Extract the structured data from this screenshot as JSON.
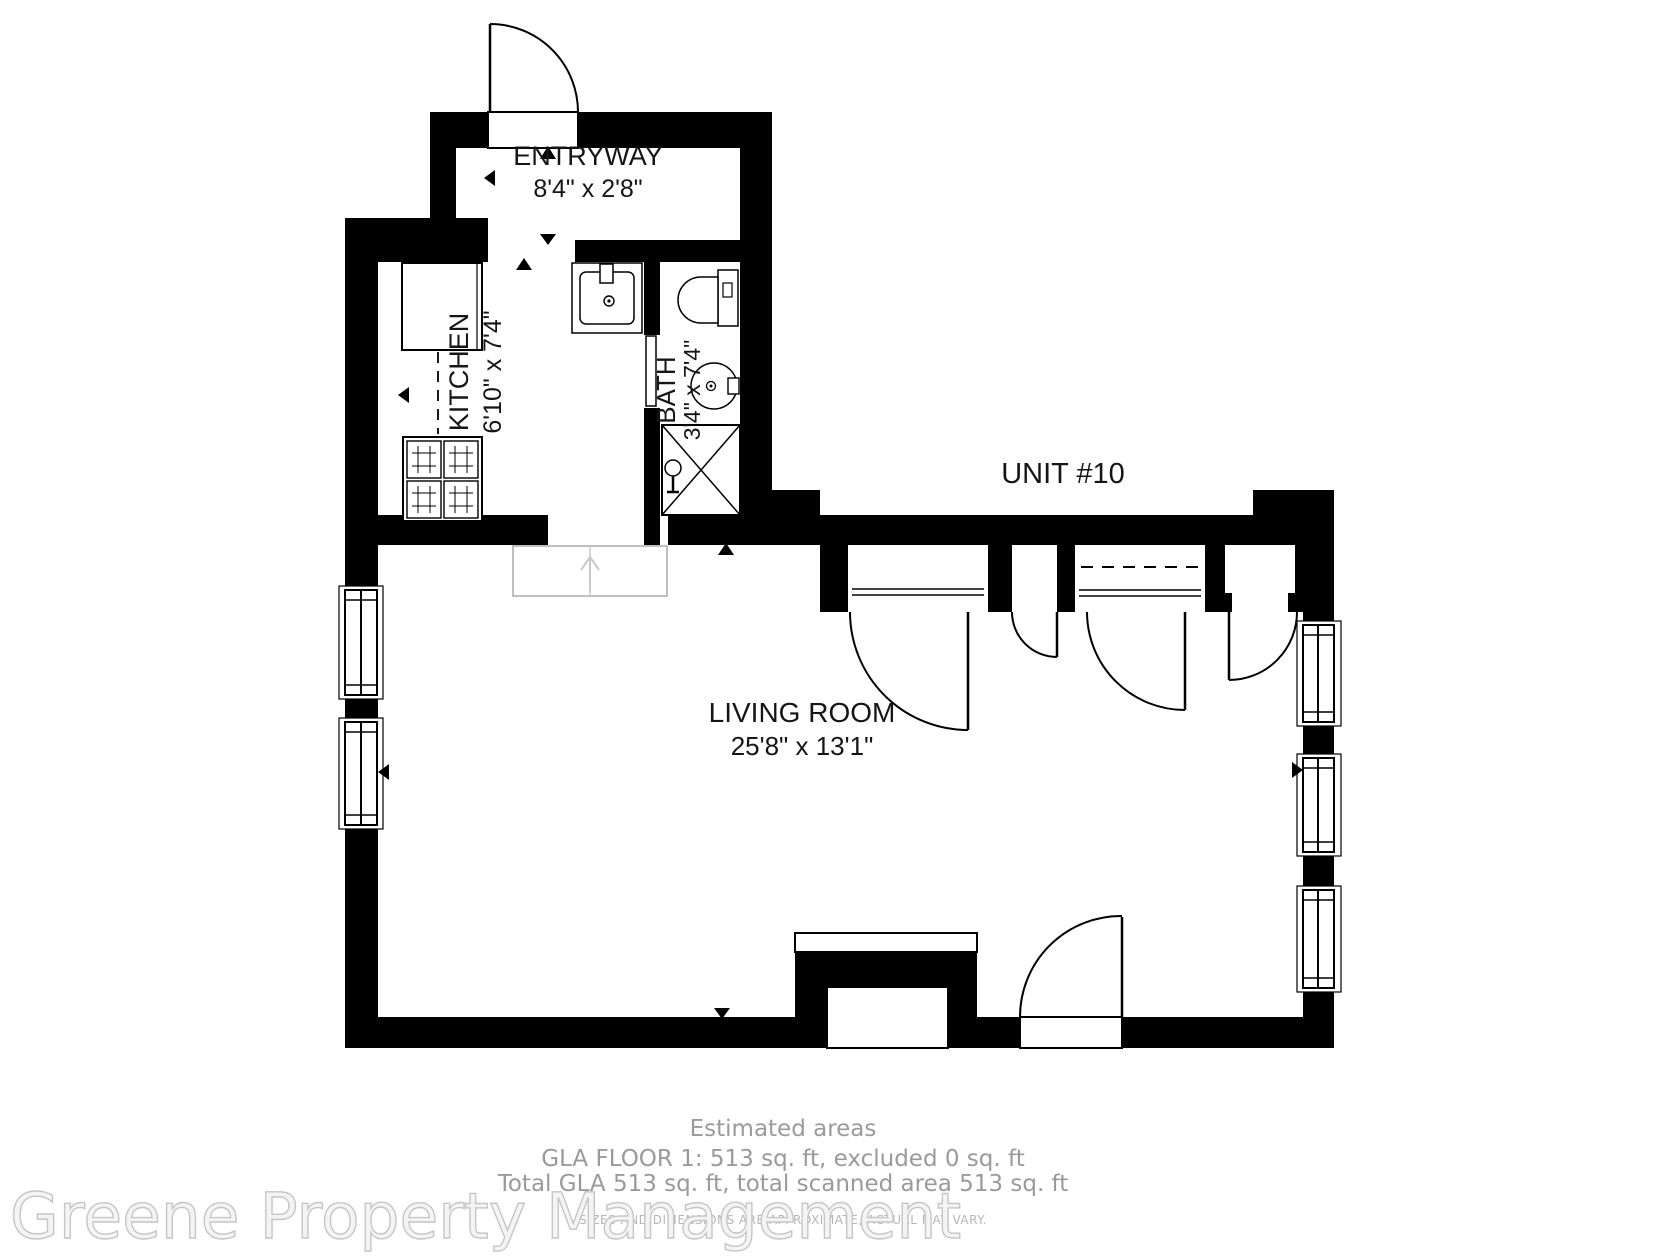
{
  "header": {
    "unit_label": "UNIT #10"
  },
  "rooms": {
    "entryway": {
      "name": "ENTRYWAY",
      "dims": "8'4\" x 2'8\""
    },
    "kitchen": {
      "name": "KITCHEN",
      "dims": "6'10\" x 7'4\""
    },
    "bath": {
      "name": "BATH",
      "dims": "3'4\" x 7'4\""
    },
    "living_room": {
      "name": "LIVING ROOM",
      "dims": "25'8\" x 13'1\""
    }
  },
  "footer": {
    "estimated_title": "Estimated areas",
    "gla_line": "GLA FLOOR 1: 513 sq. ft, excluded 0 sq. ft",
    "total_line": "Total GLA 513 sq. ft, total scanned area 513 sq. ft",
    "disclaimer": "SIZES AND DIMENSIONS ARE APPROXIMATE, ACTUAL MAY VARY.",
    "watermark": "Greene Property Management"
  },
  "colors": {
    "wall": "#000000",
    "background": "#ffffff",
    "label_text": "#151515",
    "footer_text": "#9a9a9a",
    "disclaimer_text": "#b6b6b6",
    "watermark_fill": "#f4f4f4",
    "watermark_stroke": "#c6c6c6"
  }
}
